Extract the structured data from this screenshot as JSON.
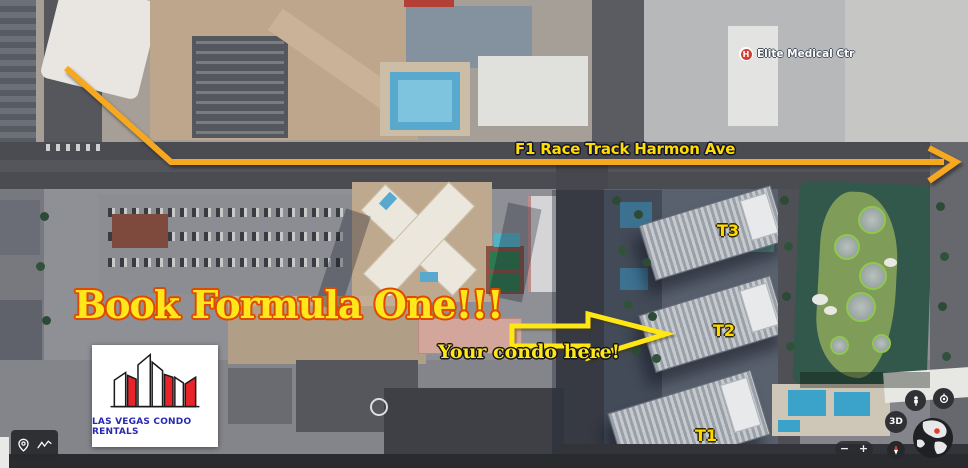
{
  "annotations": {
    "route_label": "F1 Race Track Harmon Ave",
    "headline": "Book Formula One!!!",
    "condo_label": "Your condo here!",
    "towers": [
      {
        "label": "T1"
      },
      {
        "label": "T2"
      },
      {
        "label": "T3"
      }
    ]
  },
  "map_labels": {
    "hospital": {
      "label": "Elite Medical Ctr",
      "icon_letter": "H"
    }
  },
  "logo": {
    "name": "LAS VEGAS CONDO RENTALS"
  },
  "controls": {
    "view_3d_label": "3D",
    "zoom_in_label": "+",
    "zoom_out_label": "−",
    "icons": [
      "pegman-icon",
      "my-location-icon",
      "globe-icon",
      "compass-icon",
      "pin-icon",
      "measure-icon"
    ]
  },
  "colors": {
    "route_line": "#F6A821",
    "annotation_yellow": "#FFE71C",
    "route_label_yellow": "#FFDD00",
    "headline_outline": "#E04A00",
    "logo_text_blue": "#2828B4",
    "logo_red": "#E8242A",
    "control_background": "#2F3135"
  }
}
